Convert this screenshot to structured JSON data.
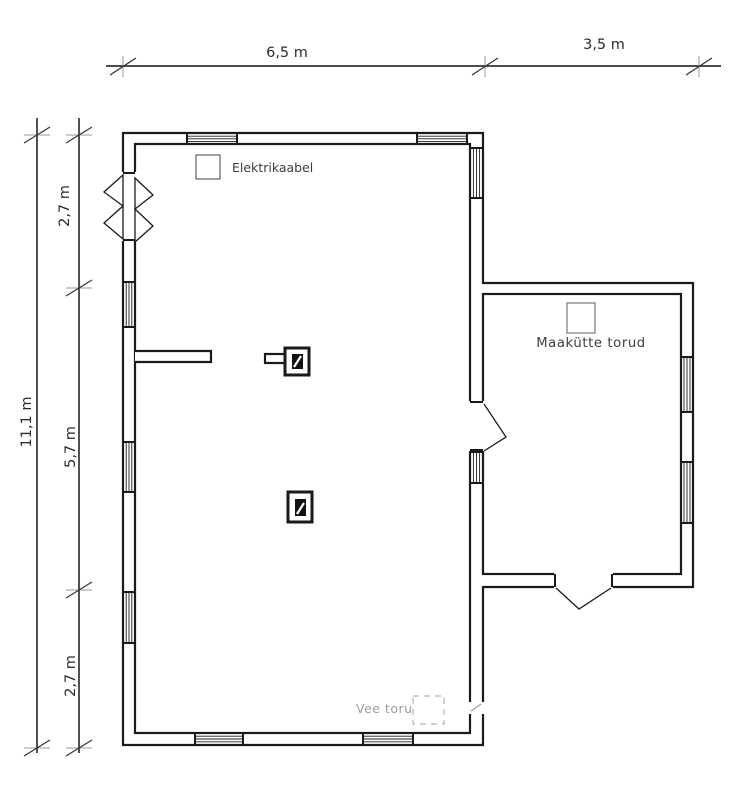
{
  "dimensions": {
    "top": [
      "6,5 m",
      "3,5 m"
    ],
    "left_total": "11,1 m",
    "left_segments": [
      "2,7 m",
      "5,7 m",
      "2,7 m"
    ]
  },
  "annotations": {
    "elektrikaabel": "Elektrikaabel",
    "maakutte_torud": "Maakütte torud",
    "vee_toru": "Vee toru"
  },
  "colors": {
    "wall": "#1a1a1a",
    "dim_line": "#333333",
    "tick_bar": "#9a9a9a",
    "annotation_text": "#3d3d3d",
    "faded_text": "#8c8c8c"
  }
}
